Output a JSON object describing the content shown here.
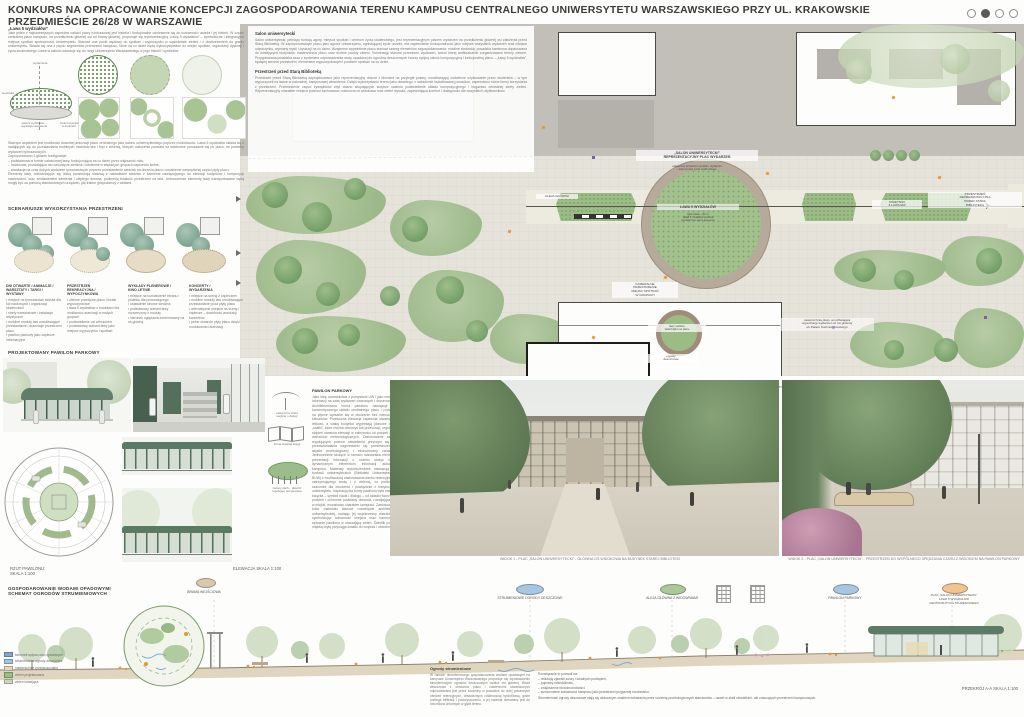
{
  "header": {
    "title": "KONKURS NA OPRACOWANIE KONCEPCJI ZAGOSPODAROWANIA TERENU KAMPUSU CENTRALNEGO UNIWERSYTETU WARSZAWSKIEGO PRZY UL. KRAKOWSKIE PRZEDMIEŚCIE 26/28 W WARSZAWIE"
  },
  "left": {
    "intro_heading": "„Ława 5 wydziałów”",
    "intro_body": "Jako jeden z najistotniejszych aspektów całości pracy konkursowej jest historia i funkcjonalne odniesienie się do tożsamości uczelni i jej historii. W części centralnej placu kampusu, na przedłużeniu głównej osi od bramy głównej, proponuje się reprezentacyjną „Ławę 5 wydziałów” – symboliczne i integracyjne miejsce spotkań społeczności Uniwersytetu. Stanowi ona punkt węzłowy do spotkań i wypoczynku w sąsiedztwie zieleni i z dostrzeżeniem do granic uniwersytetu. Składa się ona z pięciu segmentów przestrzeni kampusu, które na co dzień będą wykorzystywane do miejsc spotkań, organizacji dyskusji i życia studenckiego. Ława w całości odwołuje się do rangi Uniwersytetu Warszawskiego w jego historii i symbolice.",
    "axon_labels": {
      "top": "wydarzenia",
      "left": "siedziska",
      "right": "zieleń wysoka\nw donicach",
      "bottom": "ława 5 wydziałów –\nregulacja ustawienia"
    },
    "para2": "Ważnym aspektem jest możliwość dowolnej aranżacji placu centralnego jako salonu uniwersyteckiego poprzez modułowość. Ława 5 wydziałów składa się z nadających się do przestawiania mobilnych modułów ław i brył z zielenią, których rozłożenie pozwala na swobodne poruszanie się po placu, na potrzeby wydarzeń tymczasowych.\nZaproponowano 3 główne konfiguracje:\n– podstawowa w formie całościowej ławy, funkcjonująca na co dzień przez większość roku,\n– modułowa, pozwalająca na rozsunięcie siedzisk i siedzenie w większych grupach naprzeciw siebie,\n– aranżacja na czas dużych wydarzeń tymczasowych poprzez przestawienie siedzisk na obrzeża placu i uwolnienie wewnętrznej części płyty placu.\nElementy ławy, odznaczające się lekką konstrukcją stalową z nakładkami siedzisk z kamienia nawiązującego do elewacji budynków i kompozycji nawierzchni, oraz zestawieniem kamienia i ciepłego drewna, podkreślą trwałość przestrzeni na lata. Jednocześnie elementy ławy transportowane będą mogły być za pomocą standardowych urządzeń, jak traktor gospodarczy z widłami.",
    "scenarios_heading": "SCENARIUSZE WYKORZYSTANIA PRZESTRZENI",
    "scenarios": [
      {
        "title": "DNI OTWARTE / ANIMACJE /\nWARSZTATY / TARGI /\nWYSTAWY",
        "bullets": "▪ miejsce na tymczasowe stoiska dla kół naukowych i organizacji studenckich\n▪ strefy warsztatowe i instalacje artystyczne\n▪ mobilne moduły ław umożliwiające przestawianie i aranżacje przestrzeni placu\n▪ pawilon parkowy jako zaplecze informacyjne"
      },
      {
        "title": "PRZESTRZEŃ\nREKREACYJNA /\nWYPOCZYNKOWA",
        "bullets": "▪ zielone przedpole placu i leżaki wypoczynkowe\n▪ ława 5 wydziałów z modułami dla możliwości aranżacji w małych grupach\n▪ podświetlenie osi wieczorem\n▪ podstawowy wariant ławy jako miejsce wypoczynku i spotkań"
      },
      {
        "title": "WYKŁADY PLENEROWE /\nKINO LETNIE",
        "bullets": "▪ miejsce na rozstawienie ekranu i podestu dla prowadzącego\n▪ ustawienie kinowe siedzisk\n▪ podstawowy wariant ławy rozszerzony o moduły\n▪ kierunek oglądania zorientowany na oś główną"
      },
      {
        "title": "KONCERTY /\nWYDARZENIA",
        "bullets": "▪ miejsce na scenę z zapleczem\n▪ mobilne moduły ław umożliwiające przestawianie poza płytę placu\n▪ alternatywne miejsca na scenę i zaplecze – dowolność aranżacji koncertów\n▪ pełne otwarcie płyty placu dzięki modułowości aranżacji"
      }
    ],
    "pavilion_heading": "PROJEKTOWANY PAWILON PARKOWY",
    "rzut_label": "RZUT PAWILONU:\nSKALA 1:100",
    "elewacja_label": "ELEWACJA  SKALA 1:100"
  },
  "plan": {
    "overlay": {
      "salon_heading": "Salon uniwersytecki",
      "salon_body": "Salon uniwersytecki, pełniący funkcję agory, miejsca spotkań i centrum życia studenckiego, jest reprezentacyjnym placem wydarzeń na przedłużeniu głównej osi założenia przed Starą Biblioteką. W zaproponowanym placu jako agorze uniwersytetu, ogniskującej życie uczelni, ma zapewnienie funkcjonalności jako miejsce wszystkich wydarzeń oraz miejsce odpoczynku, wymiany myśli i dyskusji na co dzień. Wzajemne wypełnienie placu stanowi szereg elementów zagospodarowania: mobilne siedziska, posadzka kamienna dopasowana do istniejących budynków, nawierzchnia placu oraz drobne punkty zieleni. Kulminację stanowi przestrzeń wydarzeń, wokół której amfiteatralnie zorganizowano tereny zielone. Przygotowana posadzka wraz z systemem odprowadzania wody opadowej do ogrodów deszczowych tworzy spójną całość kompozycyjną i funkcjonalną placu – „Ławy 5 wydziałów”, będącej sercem przestrzeni, elementem wypoczynkowym i punktem spotkań na co dzień.",
      "przestrzen_heading": "Przestrzeń przed Starą Biblioteką",
      "przestrzen_body": "Przestrzeń przed Starą Biblioteką zaprojektowano jako reprezentacyjny obszar z błoniami na przyległe polany, umożliwiający codzienne użytkowanie przez studentów – w tym wypoczynek na ławce w naturalnej, kampusowej atmosferze. Dzięki wykorzystaniu terenu jako otwartego, o świadomie kształtowanej posadzce, zapewniono różne formy korzystania z przestrzeni. Przeniesienie części żywopłotów zbyt ciasno skupiających wnętrze uwalnia podświetlenie układu kompozycyjnego i bogactwo centralnej strefy zieleni. Reprezentacyjny charakter miejsca podnosi zachowana i widoczna oś widokowa oraz zieleń wysoka, zapewniająca komfort i dostępność dla wszystkich użytkowników."
    },
    "labels": {
      "salon_title": "„SALON UNIWERSYTECKI”\nREPREZENTACYJNY PLAC WYDARZEŃ",
      "salon_sub": "elastyczna przestrzeń spotkań, wydarzeń\ni odpoczynku życia studenckiego",
      "lawa_title": "ŁAWA 5 WYDZIAŁÓW",
      "lawa_sub": "łąka niska – 84 m\nukład 5 modułów siedzisk\nsymboliczne serce kampusu",
      "kameralne": "KAMERALNE\nPRZESTRZENIE\nMIEJSC SPOTKAŃ\nW GRUPACH",
      "lawy_mobilne": "ławy mobilne\nwokół dębu na placu",
      "reprezentacyjna": "PRZESTRZEŃ\nREPREZENTACYJNA\nPRZED STARĄ\nBIBLIOTEKĄ",
      "kwietniki": "KWIETNIKI\nZ ŁAWKAMI",
      "aleja": "ALEJA GŁÓWNA",
      "ogrody_deszczowe": "ogrody\ndeszczowe",
      "nota": "nawierzchnia placu umożliwiająca\norganizację wydarzeń od osi głównej\ndo Pałacu Kazimierzowskiego"
    },
    "caption": "RZUT ZAGOSPODAROWANIA TERENU OPRACOWANIA - Teren placu centralnego przed budynkiem Starej Biblioteki do wejścia głównego od strony Krakowskiego Przedmieścia",
    "scale": "SKALA 1:200"
  },
  "pavilion": {
    "text_heading": "PAWILON PARKOWY",
    "text_body": "Jako ideę uczestnictwa z pomysłami UW i jako miejsce informacji na czas wydarzeń czasowych i sezonowych. Architektoniczna forma pawilonu nawiązuje do koncentrycznego układu centralnego placu i pozwala na płynne wpisanie się w otoczenie bez naruszania kierunków. Przesuwna elewacja zapewnia otwartość i lekkość, a siatkę budynku wypełniają pionowe duże „szafki”, które można otworzyć lub przesunąć, regulując stopień otwarcia elewacji w zależności od potrzeb oraz warunków meteorologicznych. Zastosowanie żaluzji regulujących poziom oświetlenia przyczyni się do przeciwdziałania nagrzewaniu się pomieszczeń – aspekt proekologiczny i ekonomiczny zarazem. Jednocześnie służące w ramach stanowiska elementy prezentacji informacji o uczelni służyć będą dynamicznym elementom informacji aktualnej kampusu. Materiały wykończeniowe nawiązują do budowli uniwersyteckich (Biblioteki Uniwersyteckiej BUW) z możliwością zastosowania dachu retencyjnego, zatrzymującego wodę i z zielenią, co podkreśla szacunek dla otoczenia i powiązanie z instytucjami uniwersytetu. Inspiracją dla formy pawilonu była otwarta książka – symbol nauki i dialogu – od okładki tworzącej podcień i ochronne podstawy otwarcia, rozwijająca się w miękki, mozaikowy charakter kampusu. Zastosowany kolor materiału stanowi rozwinięcie architektury uniwersyteckiej, nadając jej współczesny charakter i symbolizując tożsamość miejsca oraz harmonijne wpisanie pawilonu w otaczającą zieleń. Świetlik ponad miękką bryłą przyciąga światło do wnętrza i otoczenia.",
    "sketch_labels": [
      "forma otwartej księgi",
      "zielony dach – płaszcz\nregulujący temperaturę",
      "elastyczna strefa\nwejścia i obsługi"
    ]
  },
  "views": {
    "view1_caption": "WIDOK 1 - PLAC „SALON UNIWERSYTECKI” - GŁÓWNA OŚ WIDOKOWA NA BUDYNEK STAREJ BIBLIOTEKI",
    "view2_caption": "WIDOK 2 - PLAC „SALON UNIWERSYTECKI” - PRZESTRZEŃ DO WSPÓLNEGO SPĘDZANIA CZASU Z WIDOKIEM NA PAWILON PARKOWY"
  },
  "bottom": {
    "heading": "GOSPODAROWANIE WODAMI OPADOWYMI\nSCHEMAT OGRODÓW STRUMIENIOWYCH",
    "markers": [
      {
        "label": "BRAMA WEJŚCIOWA"
      },
      {
        "label": "STRUMIENIOWE OGRODY DESZCZOWE"
      },
      {
        "label": "ALEJA GŁÓWNA Z WIDOWNIAMI"
      },
      {
        "label": "PAWILON PARKOWY"
      },
      {
        "label": "PLAC „SALON UNIWERSYTECKI”\nŁAWA 5 WYDZIAŁÓW\nCENTRUM ŻYCIA STUDENCKIEGO"
      }
    ],
    "legend": [
      {
        "label": "kierunek spływu wód opadowych"
      },
      {
        "label": "strumieniowe ogrody deszczowe"
      },
      {
        "label": "nawierzchnie przepuszczalne"
      },
      {
        "label": "zieleń projektowana"
      },
      {
        "label": "zieleń istniejąca"
      }
    ],
    "ogrody_heading": "Ogrody strumieniowe",
    "ogrody_left": "W ramach strumieniowego gospodarowania wodami opadowymi na kampusie Uniwersytetu Warszawskiego proponuje się wprowadzenie strumieniowych ogrodów deszczowych wzdłuż osi głównej. Woda deszczowa z obszarów placu i nawierzchni utwardzonych odprowadzana jest przez szczeliny w posadzce do niżej położonych obniżeń retencyjnych, obsadzonych roślinnością hydrofitową, gdzie podlega infiltracji i podczyszczeniu, a jej nadmiar kierowany jest do zbiorników chłonnych w głębi terenu.",
    "ogrody_intro": "Rozwiązanie to pozwoli na:",
    "ogrody_bullets": "– redukcję zjawisk suszy i lokalnych podtopień,\n– poprawę mikroklimatu,\n– zwiększenie bioróżnorodności,\n– wzmocnienie tożsamości kampusu jako przestrzeni przyjaznej środowisku.",
    "ogrody_closing": "Strumieniowe ogrody deszczowe stają się widocznym znakiem wdrażania przez uczelnię proekologicznych standardów – nawet w skali niewielkich, ale znaczących przestrzeni kampusowych.",
    "przekroj_label": "PRZEKRÓJ A-A   SKALA 1:100"
  },
  "colors": {
    "accent_green": "#93b183",
    "plan_base": "#e6e3da",
    "lawn": "#a3c18c",
    "marker_blue": "#a6c6e2",
    "marker_orange": "#f0c48a",
    "marker_green": "#aac89a",
    "boundary_red": "#7e1f1f"
  }
}
